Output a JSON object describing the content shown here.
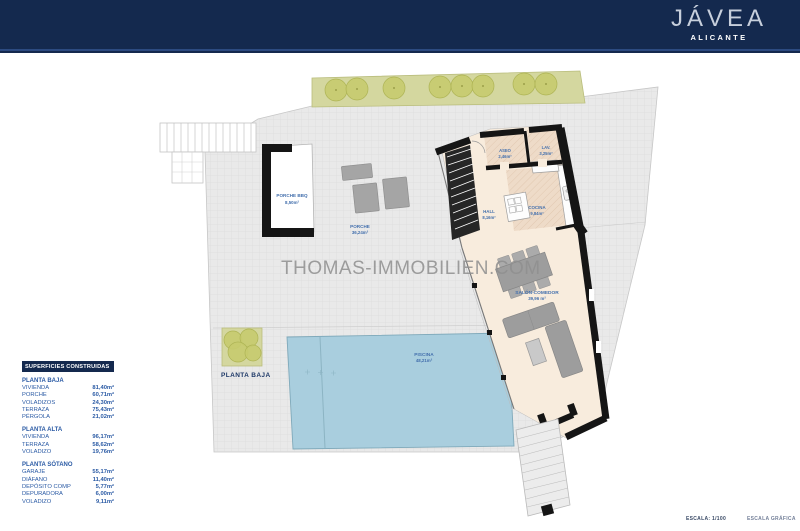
{
  "header": {
    "brand": "JÁVEA",
    "location": "ALICANTE"
  },
  "watermark": "THOMAS-IMMOBILIEN.COM",
  "plan": {
    "floor_label": "PLANTA BAJA",
    "rooms": [
      {
        "name": "PORCHE BBQ",
        "area": "8,50m²"
      },
      {
        "name": "PORCHE",
        "area": "36,24m²"
      },
      {
        "name": "ASEO",
        "area": "2,46m²"
      },
      {
        "name": "LAV.",
        "area": "3,25m²"
      },
      {
        "name": "COCINA",
        "area": "9,84m²"
      },
      {
        "name": "HALL",
        "area": "8,16m²"
      },
      {
        "name": "SALÓN-COMEDOR",
        "area": "39,96 m²"
      },
      {
        "name": "PISCINA",
        "area": "48,21m²"
      }
    ]
  },
  "areas_table": {
    "title": "SUPERFICIES CONSTRUIDAS",
    "sections": [
      {
        "name": "PLANTA BAJA",
        "rows": [
          {
            "label": "VIVIENDA",
            "value": "81,40m²"
          },
          {
            "label": "PORCHE",
            "value": "60,71m²"
          },
          {
            "label": "VOLADIZOS",
            "value": "24,30m²"
          },
          {
            "label": "TERRAZA",
            "value": "75,43m²"
          },
          {
            "label": "PÉRGOLA",
            "value": "21,02m²"
          }
        ]
      },
      {
        "name": "PLANTA ALTA",
        "rows": [
          {
            "label": "VIVIENDA",
            "value": "96,17m²"
          },
          {
            "label": "TERRAZA",
            "value": "58,62m²"
          },
          {
            "label": "VOLADIZO",
            "value": "19,76m²"
          }
        ]
      },
      {
        "name": "PLANTA SÓTANO",
        "rows": [
          {
            "label": "GARAJE",
            "value": "55,17m²"
          },
          {
            "label": "DIÁFANO",
            "value": "11,40m²"
          },
          {
            "label": "DEPÓSITO COMP",
            "value": "5,77m²"
          },
          {
            "label": "DEPURADORA",
            "value": "6,00m²"
          },
          {
            "label": "VOLADIZO",
            "value": "9,11m²"
          }
        ]
      }
    ]
  },
  "footer": {
    "scale": "ESCALA:  1/100",
    "graphic_scale": "ESCALA GRÁFICA"
  },
  "colors": {
    "navy": "#14294e",
    "table_blue": "#2a5aa4",
    "label_blue": "#4470ad",
    "terrace_gray": "#e9e9e9",
    "interior_beige": "#f8ecdd",
    "tile_tan": "#eedbc8",
    "pool_blue": "#a9cede",
    "planting_green": "#d4d79f",
    "wall_black": "#151515"
  }
}
